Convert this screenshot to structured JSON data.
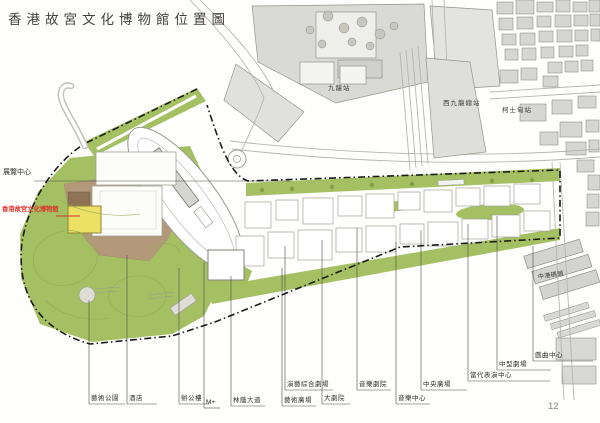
{
  "page": {
    "title": "香港故宮文化博物館位置圖",
    "page_number": "12"
  },
  "map": {
    "stations": {
      "kowloon": "九龍站",
      "west_kowloon_terminus": "西九龍總站",
      "austin": "柯士甸站"
    },
    "landmarks": {
      "exhibition_centre": "展覽中心",
      "palace_museum": "香港故宮文化博物館",
      "china_ferry_terminal": "中港碼頭"
    },
    "bottom_labels": [
      {
        "text": "藝術公園"
      },
      {
        "text": "酒店"
      },
      {
        "text": "辦公樓"
      },
      {
        "text": "M+"
      },
      {
        "text": "林蔭大道"
      },
      {
        "text": "演藝綜合劇場"
      },
      {
        "text": "藝術廣場"
      },
      {
        "text": "大劇院"
      },
      {
        "text": "音樂劇院"
      },
      {
        "text": "音樂中心"
      },
      {
        "text": "中央廣場"
      },
      {
        "text": "當代表演中心"
      },
      {
        "text": "中型劇場"
      },
      {
        "text": "戲曲中心"
      }
    ],
    "colors": {
      "park_green": "#a5c063",
      "museum_yellow": "#ece065",
      "museum_label_red": "#d9342b",
      "site_tan": "#b39879",
      "urban_gray": "#d9d9d5"
    }
  }
}
